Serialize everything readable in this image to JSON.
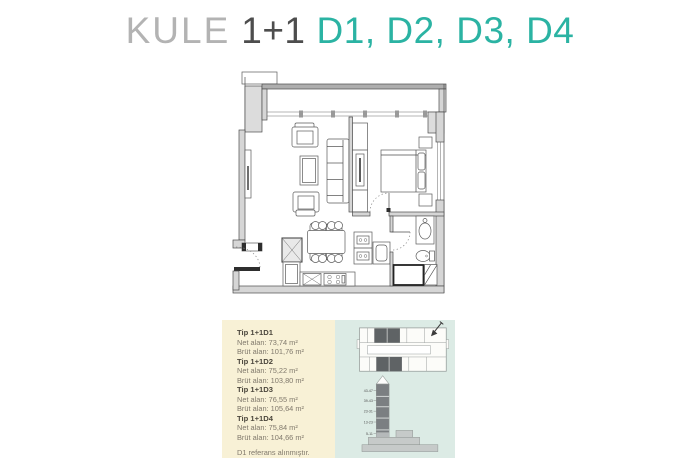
{
  "title": {
    "building": "KULE",
    "plan_type": "1+1",
    "unit_list": "D1, D2, D3, D4"
  },
  "info_panel": {
    "units": [
      {
        "name": "Tip 1+1D1",
        "net": "Net alan: 73,74 m²",
        "brut": "Brüt alan: 101,76 m²"
      },
      {
        "name": "Tip 1+1D2",
        "net": "Net alan: 75,22 m²",
        "brut": "Brüt alan: 103,80 m²"
      },
      {
        "name": "Tip 1+1D3",
        "net": "Net alan: 76,55 m²",
        "brut": "Brüt alan: 105,64 m²"
      },
      {
        "name": "Tip 1+1D4",
        "net": "Net alan: 75,84 m²",
        "brut": "Brüt alan: 104,66 m²"
      }
    ],
    "footnote": "D1 referans alınmıştır.",
    "tower": {
      "floor_labels": [
        "43-47",
        "39-43",
        "23-31",
        "13-23",
        "5-11"
      ]
    }
  },
  "colors": {
    "accent_teal": "#2bb3a3",
    "title_gray": "#b3b3b3",
    "title_dark": "#4d4d4d",
    "panel_cream": "#f8f1d6",
    "panel_mint": "#dcebe5",
    "plan_line": "#4c4c4c",
    "tower_dark": "#7b7f82"
  }
}
